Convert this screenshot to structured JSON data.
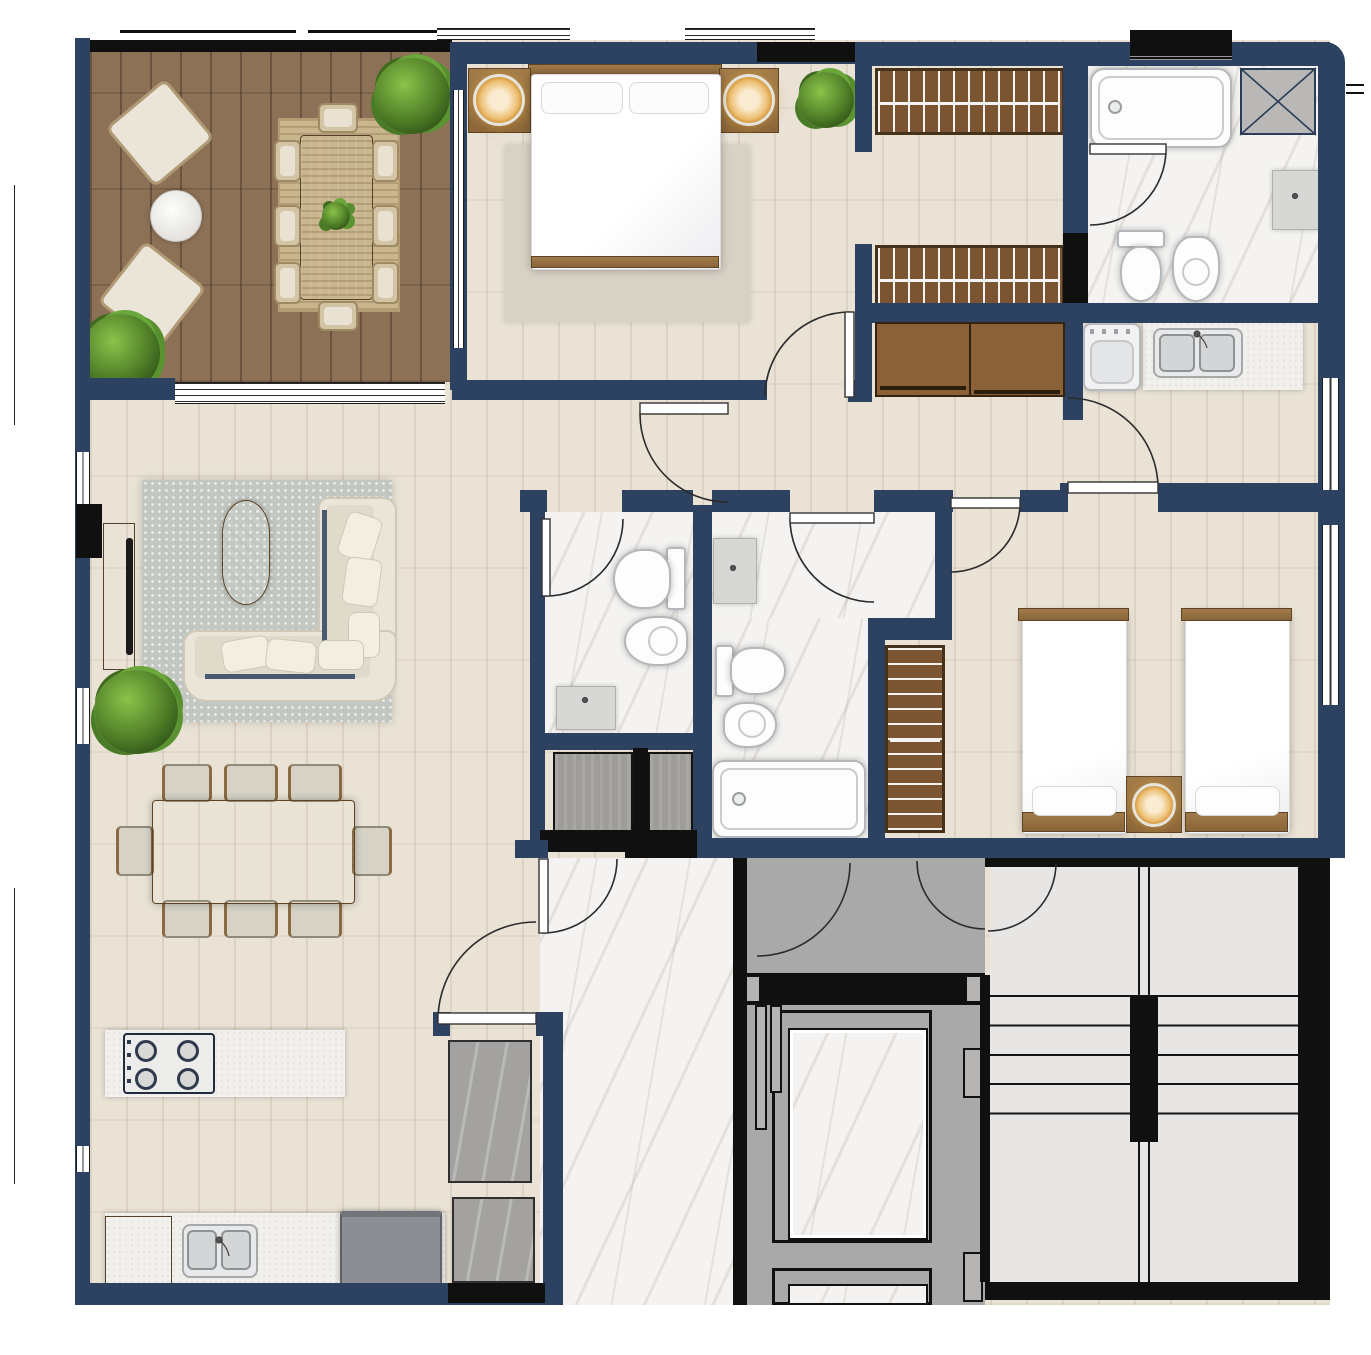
{
  "page": {
    "title": "Apartment Floor Plan",
    "type": "architectural-top-view-render",
    "visible_text": []
  },
  "palette": {
    "wall": "#2d4160",
    "wall_black": "#101010",
    "deck": "#8d7156",
    "floor": "#e9e2d5",
    "marble": "#f4f3f1",
    "gray_floor": "#a9a9a9",
    "tile": "#e7e6e4",
    "rug_jute": "#c9b58e",
    "rug_gray": "#c2c7c2",
    "rug_beige": "#d8d1c5",
    "counter": "#f1f0ed",
    "appliance": "#8b8f93",
    "wood": "#8a6538",
    "glow": "#edbf72",
    "plant_green": "#5a9431"
  },
  "rooms": [
    {
      "id": "terrace",
      "label": "Terrace",
      "floor": "wood-deck",
      "furniture": [
        "lounge-chair",
        "lounge-chair",
        "round-side-table",
        "outdoor-dining-table",
        "8-wicker-chairs",
        "jute-rug",
        "potted-plant",
        "potted-plant",
        "table-plant"
      ]
    },
    {
      "id": "master-bedroom",
      "label": "Master Bedroom",
      "floor": "light-wood",
      "furniture": [
        "double-bed",
        "headboard",
        "nightstand-left",
        "nightstand-right",
        "lamp",
        "lamp",
        "area-rug",
        "plant",
        "swing-door"
      ]
    },
    {
      "id": "walk-in-closet",
      "label": "Walk-in Closet",
      "floor": "light-wood",
      "furniture": [
        "wardrobe-with-hangers",
        "wardrobe-with-hangers"
      ]
    },
    {
      "id": "ensuite-bathroom",
      "label": "En-suite Bathroom",
      "floor": "marble",
      "furniture": [
        "bathtub",
        "toilet",
        "bidet",
        "wall-sink",
        "duct-shaft-x",
        "swing-door"
      ]
    },
    {
      "id": "laundry-kitchenette",
      "label": "Laundry / Kitchenette",
      "floor": "light-wood",
      "furniture": [
        "washing-machine",
        "double-sink-counter",
        "swing-door"
      ]
    },
    {
      "id": "hallway",
      "label": "Hallway",
      "floor": "light-wood",
      "furniture": [
        "sliding-door-closet",
        "swing-door"
      ]
    },
    {
      "id": "living-room",
      "label": "Living Room",
      "floor": "light-wood",
      "furniture": [
        "l-shaped-sofa",
        "cushions",
        "oval-coffee-table",
        "gray-rug",
        "tv-console",
        "tv",
        "plant"
      ]
    },
    {
      "id": "dining-area",
      "label": "Dining Area",
      "floor": "light-wood",
      "furniture": [
        "dining-table",
        "8-dining-chairs"
      ]
    },
    {
      "id": "kitchen",
      "label": "Kitchen",
      "floor": "light-wood",
      "furniture": [
        "island-counter",
        "gas-hob-4-burners",
        "base-cabinet",
        "double-sink",
        "refrigerator"
      ]
    },
    {
      "id": "bathroom-1",
      "label": "Bathroom 1",
      "floor": "marble",
      "furniture": [
        "toilet",
        "bidet",
        "vanity-sink",
        "swing-door"
      ]
    },
    {
      "id": "bathroom-2",
      "label": "Bathroom 2",
      "floor": "marble",
      "furniture": [
        "vanity-sink",
        "toilet",
        "bidet",
        "bathtub",
        "swing-door"
      ]
    },
    {
      "id": "bedroom-2",
      "label": "Bedroom 2",
      "floor": "light-wood",
      "furniture": [
        "single-bed",
        "single-bed",
        "shared-nightstand",
        "lamp",
        "wardrobe-with-hangers",
        "swing-door"
      ]
    },
    {
      "id": "utility-shafts",
      "label": "Utility Shafts",
      "floor": "concrete",
      "furniture": []
    },
    {
      "id": "entry-foyer",
      "label": "Entry Foyer",
      "floor": "marble",
      "furniture": [
        "entrance-door",
        "gray-panel",
        "gray-panel"
      ]
    },
    {
      "id": "elevator-lobby",
      "label": "Elevator Lobby",
      "floor": "gray-screed",
      "furniture": [
        "elevator-cabin",
        "elevator-cabin-partial",
        "lobby-door",
        "lobby-door"
      ]
    },
    {
      "id": "stairwell",
      "label": "Stairwell",
      "floor": "gray-tile",
      "furniture": [
        "stair-flight-up",
        "stair-flight-down",
        "landing",
        "landing",
        "swing-door"
      ]
    }
  ],
  "annotations": {
    "dimension_lines": 2,
    "tick_marks": 2
  }
}
